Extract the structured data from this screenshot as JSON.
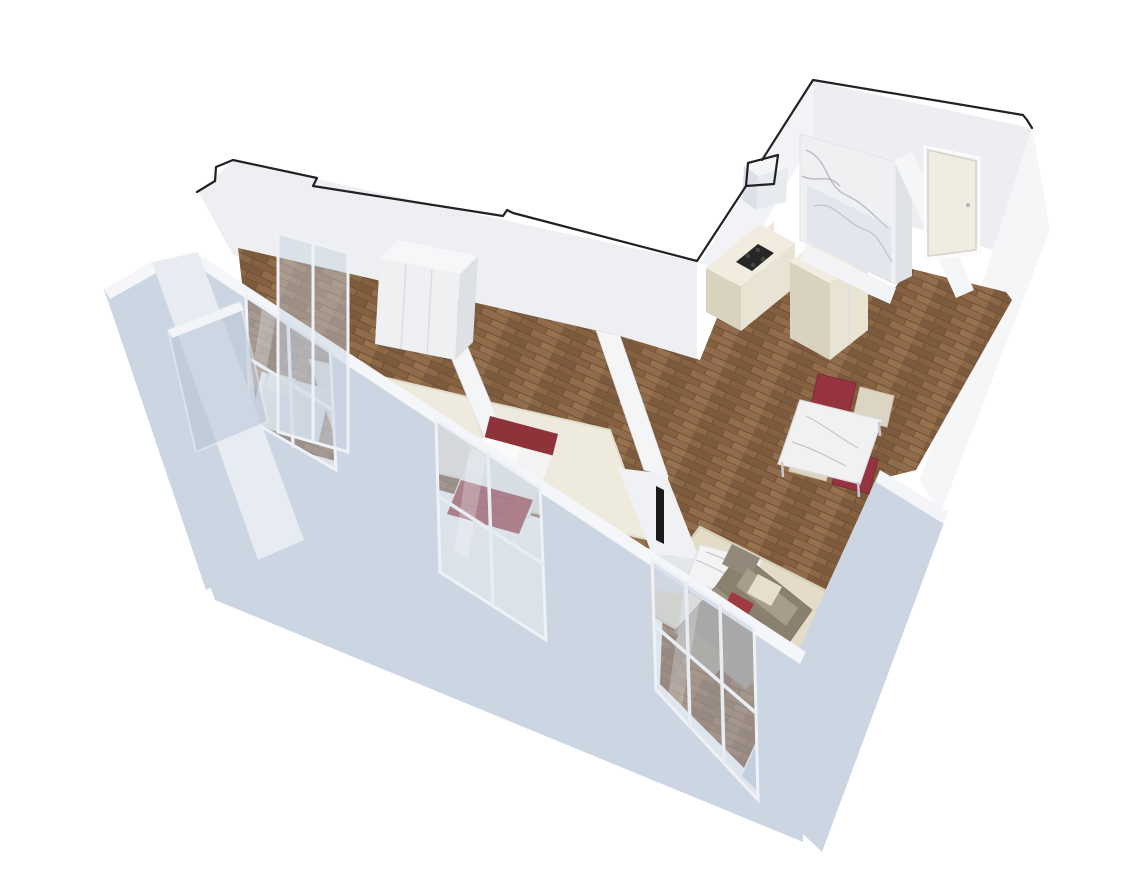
{
  "meta": {
    "content_type": "3d-apartment-floor-plan-render",
    "view": "isometric-perspective-cutaway",
    "background": "#ffffff",
    "visible_text": "none"
  },
  "palette": {
    "background": "#ffffff",
    "cut_outline": "#222222",
    "wall_white": "#f2f3f6",
    "wall_face": "#edeff2",
    "wall_shade": "#dde0e6",
    "facade_blue_grey": "#ccd6e3",
    "facade_light": "#e7ecf3",
    "facade_top_band": "#f4f6f9",
    "glass": "#b9c6d6",
    "wood_floor": "#8a6548",
    "wood_floor_dark": "#6b4c33",
    "rug_cream": "#eeeade",
    "rug_beige": "#e4dcc9",
    "marble": "#f2f2f3",
    "marble_vein": "#a9abb4",
    "accent_red": "#9d3a41",
    "accent_red_dark": "#83303a",
    "chair_red": "#963340",
    "chair_cream": "#ddd5c3",
    "sofa_taupe": "#968c7b",
    "sofa_dark": "#8a8070",
    "sofa_light": "#a79d8c",
    "cushion_cream": "#e7dfcd",
    "cabinet_cream": "#e9e3d3",
    "cabinet_side": "#d9d2bf",
    "cabinet_top": "#f1ecdf",
    "cooktop_black": "#262626",
    "tv_black": "#1a1a1a",
    "door_cream": "#efece1",
    "metal": "#b9bdc2"
  },
  "scene": {
    "building_shape": "L-shaped apartment, cut-open walls, bird's eye view from south-west",
    "rooms": [
      {
        "id": "bedroom-main",
        "position": "upper-left-wing",
        "furniture": [
          "wardrobe-3-door",
          "bed",
          "white-area-rug",
          "red-folded-blanket",
          "glazed-partition"
        ]
      },
      {
        "id": "bedroom-second",
        "position": "center",
        "furniture": [
          "single-bed-red-headboard",
          "white-pillows",
          "red-blanket",
          "white-area-rug",
          "closet",
          "tv-panel"
        ]
      },
      {
        "id": "living-room",
        "position": "bottom-right",
        "furniture": [
          "corner-sofa-taupe",
          "red-cushion",
          "cream-cushion",
          "marble-coffee-table",
          "beige-area-rug"
        ]
      },
      {
        "id": "kitchen",
        "position": "center-right",
        "furniture": [
          "cream-cabinet-run",
          "black-cooktop",
          "tall-pantry-cabinet"
        ]
      },
      {
        "id": "dining-area",
        "position": "right",
        "furniture": [
          "marble-dining-table"
        ],
        "chairs": {
          "red": 2,
          "cream": 2
        }
      },
      {
        "id": "bathroom",
        "position": "top-right",
        "furniture": [
          "marble-walk-in-shower",
          "glass-screen"
        ]
      },
      {
        "id": "entry-hallway",
        "position": "top-right",
        "furniture": [
          "entry-door"
        ],
        "floor": "wood-parquet"
      },
      {
        "id": "loggia-balcony",
        "position": "far-left",
        "furniture": [
          "glass-railing"
        ]
      }
    ],
    "floors": {
      "main_areas": "wood-parquet-brown",
      "bedroom_rugs": "cream-white",
      "living_rug": "beige"
    },
    "walls": {
      "exterior_facade": "light-blue-grey with large glazed windows",
      "interior": "white",
      "top_cut_line": "black"
    },
    "windows": [
      "loggia-glazing",
      "bedroom-main-window",
      "bedroom-second-window",
      "living-room-glass-door"
    ]
  }
}
